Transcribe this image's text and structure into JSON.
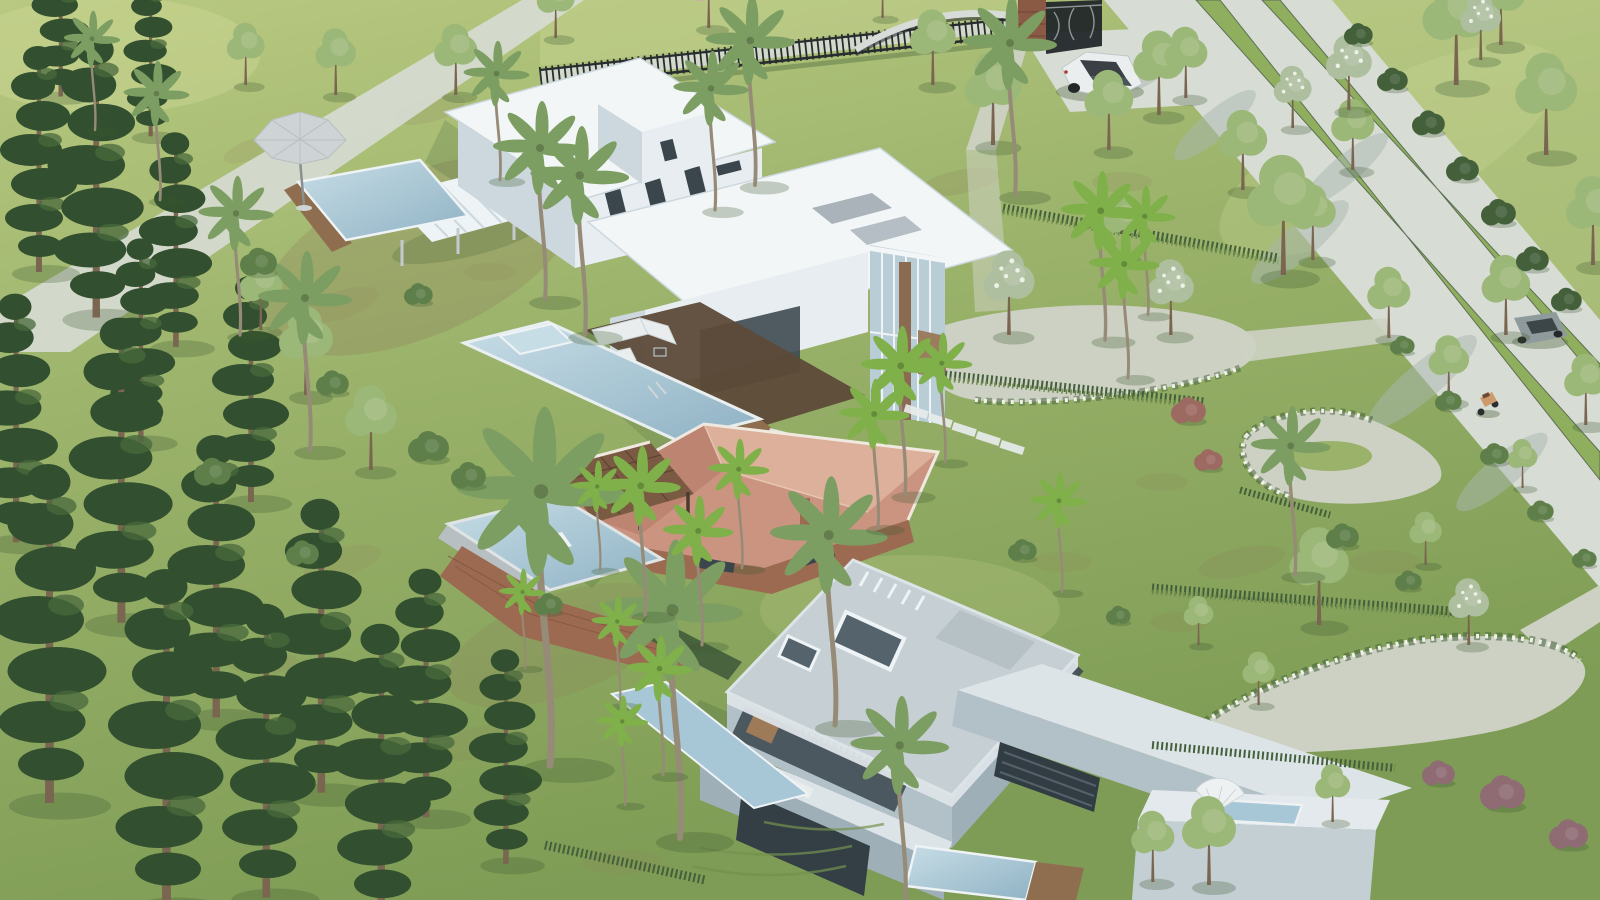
{
  "meta": {
    "title": "Aerial 3D architectural render of a gated tropical villa estate",
    "view": "three-quarter aerial view in bright daylight, shadows falling to the lower left",
    "image_size": "1600x900"
  },
  "colors": {
    "grassLight": "#b9c981",
    "grassMid": "#9ab26a",
    "grassDark": "#7e9c55",
    "grassSun": "#cbd795",
    "mottleBrown": "#8f805c",
    "mottleDark": "#6d8a4c",
    "road": "#d7dcd4",
    "roadShade": "#a8b7b1",
    "gravel": "#cdd1c3",
    "median": "#8fae5e",
    "pine": "#324f2f",
    "pineLight": "#48683c",
    "treeGreen": "#9cb878",
    "treeDark": "#5f7f4a",
    "palmGray": "#7d9e62",
    "palmBright": "#7fb04a",
    "flowerTree": "#aebfa0",
    "flowerWhite": "#eef2e6",
    "treePinkBloom": "#d3a8b4",
    "shrubPurple": "#8f6b74",
    "shrubRed": "#9d6a62",
    "hedge": "#44603b",
    "trunkBrown": "#7a6650",
    "palmTrunk": "#968b77",
    "whiteRoof": "#f3f6f7",
    "whiteWall": "#e7edf0",
    "wallShade": "#ccd8de",
    "wallDark": "#b0c0c8",
    "windowDark": "#3a454c",
    "glassBlue": "#b9cdd6",
    "mullion": "#eef3f5",
    "bRoof": "#c6cfd3",
    "bWall": "#b2c0c8",
    "bWallDark": "#9fafb8",
    "bWallLight": "#dde4e8",
    "louverDark": "#4b5861",
    "interiorWarm": "#c08a55",
    "terracottaLight": "#dcb09a",
    "terracotta": "#cb9480",
    "terracottaDark": "#b67f6b",
    "fascia": "#efe9df",
    "shingle": "#7a5a42",
    "brick": "#9c6a50",
    "brickDark": "#7c5340",
    "poolLight": "#c7dde6",
    "pool": "#a7c6d6",
    "poolDeep": "#8fb2c4",
    "deckWood": "#8e6e4e",
    "deckDark": "#5d4a38",
    "fenceDark": "#272c2f",
    "furnitureWhite": "#e9edee",
    "suvWhite": "#ebeeee",
    "suvDark": "#3a4045",
    "carGray": "#8f9a9c",
    "scooterOrange": "#cf9a6b",
    "umbrellaGray": "#ced4d5",
    "shadow": "#3e5a34"
  },
  "scene": {
    "setting": "manicured tropical estate with three luxury houses on rolling lawns",
    "boundary": {
      "fence": "dark wrought-iron picket fence along the top edge",
      "gate": "ornate scrollwork gate with a masonry pillar",
      "curved_wall": "low curved wall segment beside the gate"
    },
    "roads": {
      "main_road": "light concrete avenue crossing the right side diagonally",
      "median_strips": "two grass median strips with street trees and a clipped hedge",
      "driveway": "parking apron inside the gate where a white SUV is parked",
      "gravel_court": "oval gravel court in front of the glazed facade of the north villa",
      "garden_paths": "winding gravel paths with white-flowering borders in the lower-right lawns"
    },
    "buildings": [
      {
        "id": "villa-north",
        "style": "white flat-roof modern villa, two storeys",
        "features": [
          "roof-access tower",
          "large cantilevered roof slab",
          "glazed east facade with timber feature column",
          "covered terrace with white sectional sofa",
          "long pool with raised spa and chrome ladder",
          "slatted pergola wing",
          "small plunge pool with timber deck",
          "octagonal grey patio umbrella"
        ]
      },
      {
        "id": "house-middle",
        "style": "single-storey house with terracotta hip roof",
        "features": [
          "brown shingle pergola",
          "brick lower walls",
          "raised infinity pool on a brick retaining base",
          "corner spa"
        ]
      },
      {
        "id": "villa-south",
        "style": "grey concrete modern villa, two storeys",
        "features": [
          "flat roof with two skylights",
          "vertical louvre screens",
          "warm-lit glazing",
          "long cantilevered wing ending in a white cube",
          "rooftop plunge pool with white shell parasol",
          "lap pool below the garage opening",
          "narrow reflecting pool on the west slope",
          "two white sun loungers",
          "terraced lawn steps"
        ]
      }
    ],
    "vehicles": [
      {
        "id": "suv",
        "description": "white compact SUV with dark roof parked inside the gate"
      },
      {
        "id": "sedan",
        "description": "grey car on the avenue near the right edge"
      },
      {
        "id": "scooter",
        "description": "tan scooter on the lower stretch of the avenue"
      }
    ],
    "vegetation": {
      "conifers": "tall dark araucaria pines along the left edge and lower-left corner",
      "coconut_palms": "very tall grey-green coconut palms scattered across the estate",
      "fan_palms": "clusters of bright green palms beside each house",
      "street_trees": "young light-green trees lining the avenue verges",
      "flowering": "white-flowering trees by the gravel court, pink-flowering trees beyond the fence, purple and rust shrubs lower right",
      "hedges_and_grasses": "clipped hedge along the avenue, bands of tall ornamental grass between lawn terraces"
    }
  }
}
